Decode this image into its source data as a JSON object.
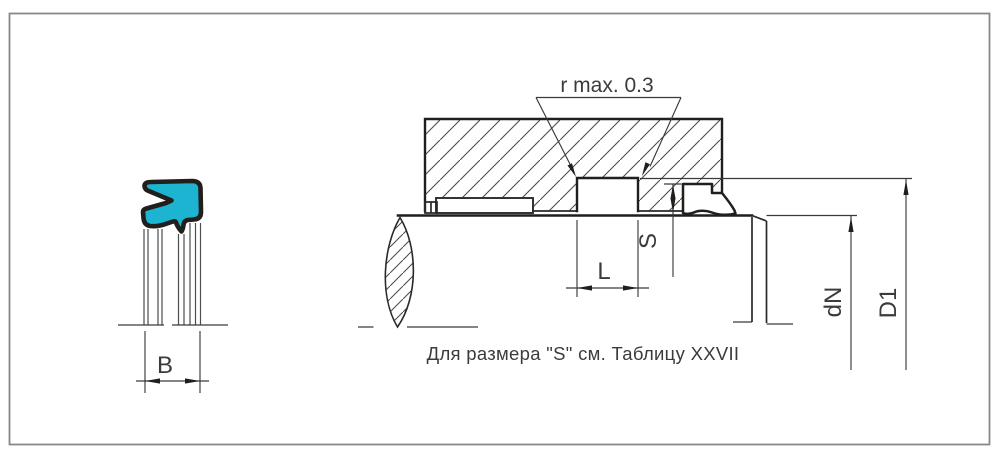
{
  "drawing": {
    "type": "engineering-seal-installation-diagram",
    "caption": "Для размера \"S\" см. Таблицу XXVII",
    "r_annotation": "r  max. 0.3",
    "dim_b": "B",
    "dim_l": "L",
    "dim_s": "S",
    "dim_dn": "dN",
    "dim_d1": "D1",
    "colors": {
      "seal_fill": "#1db4d1",
      "outline_dark": "#211e1c",
      "line_color": "#3a3a3a",
      "hatch_color": "#4c4c4c",
      "frame_color": "#8b8888",
      "text_color": "#3b3b3b",
      "background": "#ffffff"
    }
  }
}
